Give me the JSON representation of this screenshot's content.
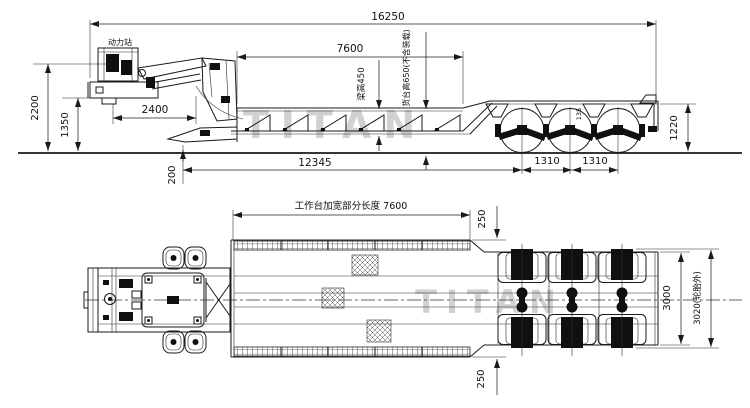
{
  "watermark": {
    "text": "TITAN"
  },
  "side_view": {
    "power_station_label": "动力站",
    "dim_overall_length": "16250",
    "dim_deck_length": "7600",
    "dim_beam_height": "梁高450",
    "dim_deck_height": "货台高650(不含装载)",
    "dim_overall_height": "2200",
    "dim_gooseneck_height": "1350",
    "dim_gooseneck_length": "2400",
    "dim_lower_deck_length": "12345",
    "dim_nose_height": "200",
    "dim_axle_detail": "135",
    "dim_axle_spacing_1": "1310",
    "dim_axle_spacing_2": "1310",
    "dim_rear_height": "1220"
  },
  "plan_view": {
    "dim_work_platform_length": "工作台加宽部分长度 7600",
    "dim_widening_top": "250",
    "dim_widening_bottom": "250",
    "dim_frame_width": "3000",
    "dim_tire_width": "3020(轮胎外)"
  }
}
